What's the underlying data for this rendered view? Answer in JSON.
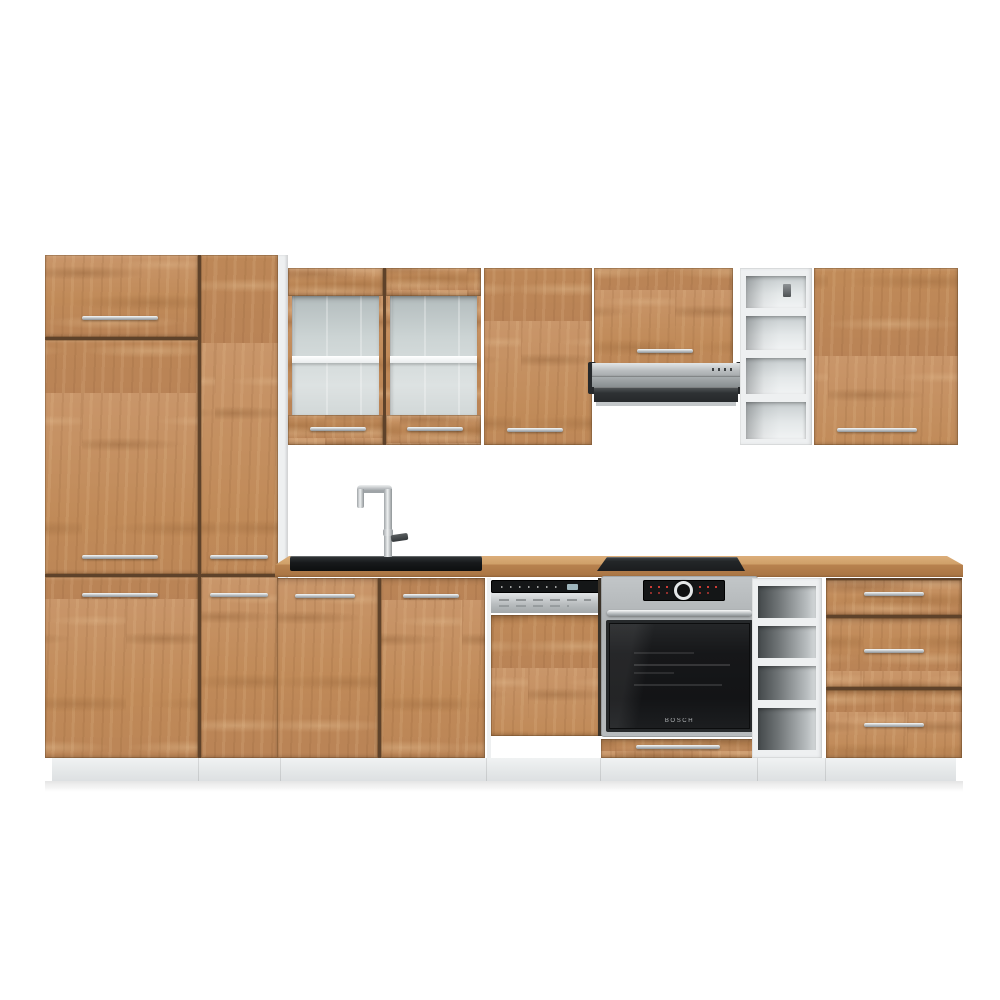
{
  "meta": {
    "description": "Product photo of a modular kitchen set with oak-effect fronts, white carcass and built-in appliances on a white background"
  },
  "appliances": {
    "oven": {
      "brand_label": "BOSCH"
    }
  },
  "components": {
    "tall_cabinet": "Tall pantry cabinet",
    "glass_wall_cabinet": "Glass wall cabinet",
    "solid_wall_cabinet": "Wall cabinet",
    "hood_cabinet": "Extractor hood cabinet",
    "extractor_hood": "Slide-out extractor hood",
    "wall_open_shelf": "Open wall shelf unit",
    "right_wall_cabinet": "Wall cabinet right",
    "countertop": "Wooden worktop",
    "sink": "Inset sink with mixer tap",
    "cooktop": "Black built-in hob",
    "sink_base_cabinet": "Sink base cabinet",
    "dishwasher": "Semi-integrated dishwasher",
    "oven": "Built-in oven",
    "base_open_shelf": "Open base shelf unit",
    "drawer_unit": "Three-drawer base unit",
    "plinth": "White plinth"
  },
  "colors": {
    "wood_base": "#c18a58",
    "wood_light": "#e0b486",
    "wood_dark": "#8a5f3a",
    "carcass_white": "#eef0f1",
    "plinth_gray": "#e6e8ea",
    "steel": "#b9bdbf",
    "appliance_black": "#17181a",
    "display_red": "#e2403a",
    "background": "#ffffff"
  }
}
